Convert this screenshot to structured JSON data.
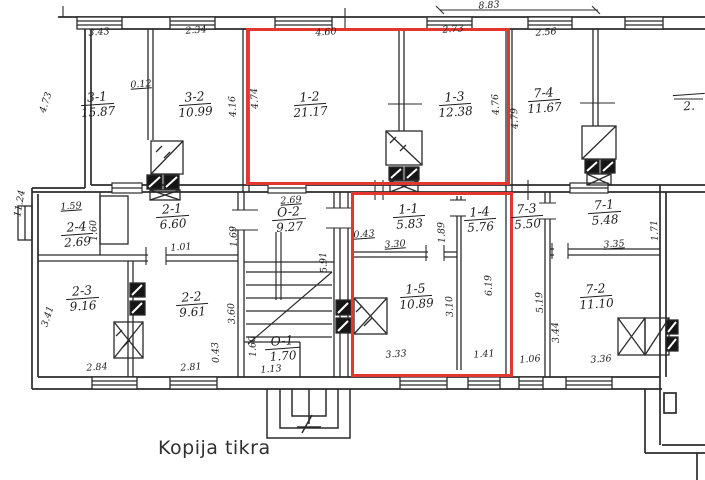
{
  "caption": "Kopija tikra",
  "colors": {
    "line": "#2b2b2b",
    "highlight": "#e2362f",
    "paper": "#ffffff"
  },
  "rooms": {
    "r31": {
      "no": "3-1",
      "area": "15.87"
    },
    "r32": {
      "no": "3-2",
      "area": "10.99"
    },
    "r12": {
      "no": "1-2",
      "area": "21.17"
    },
    "r13": {
      "no": "1-3",
      "area": "12.38"
    },
    "r74": {
      "no": "7-4",
      "area": "11.67"
    },
    "r24": {
      "no": "2-4",
      "area": "2.69"
    },
    "r21": {
      "no": "2-1",
      "area": "6.60"
    },
    "rO2": {
      "no": "O-2",
      "area": "9.27"
    },
    "r11": {
      "no": "1-1",
      "area": "5.83"
    },
    "r14": {
      "no": "1-4",
      "area": "5.76"
    },
    "r73": {
      "no": "7-3",
      "area": "5.50"
    },
    "r71": {
      "no": "7-1",
      "area": "5.48"
    },
    "r23": {
      "no": "2-3",
      "area": "9.16"
    },
    "r22": {
      "no": "2-2",
      "area": "9.61"
    },
    "rO1": {
      "no": "O-1",
      "area": "1.70"
    },
    "r15": {
      "no": "1-5",
      "area": "10.89"
    },
    "r72": {
      "no": "7-2",
      "area": "11.10"
    },
    "rEdge": {
      "no": "",
      "area": "2."
    }
  },
  "dims": {
    "d343": "3.43",
    "d234": "2.34",
    "d460": "4.60",
    "d273": "2.73",
    "d883": "8.83",
    "d256": "2.56",
    "d012": "0.12",
    "d473": "4.73",
    "d416": "4.16",
    "d474": "4.74",
    "d476": "4.76",
    "d479": "4.79",
    "d1124": "11.24",
    "d159": "1.59",
    "d160a": "1.60",
    "d101": "1.01",
    "d169": "1.69",
    "d269": "2.69",
    "d591": "5.91",
    "d341": "3.41",
    "d284": "2.84",
    "d281": "2.81",
    "d360": "3.60",
    "d043a": "0.43",
    "d160b": "1.60",
    "d113": "1.13",
    "d043b": "0.43",
    "d330": "3.30",
    "d189": "1.89",
    "d619": "6.19",
    "d310": "3.10",
    "d333": "3.33",
    "d141": "1.41",
    "d519": "5.19",
    "d335": "3.35",
    "d171": "1.71",
    "d106": "1.06",
    "d336": "3.36",
    "d344": "3.44"
  }
}
